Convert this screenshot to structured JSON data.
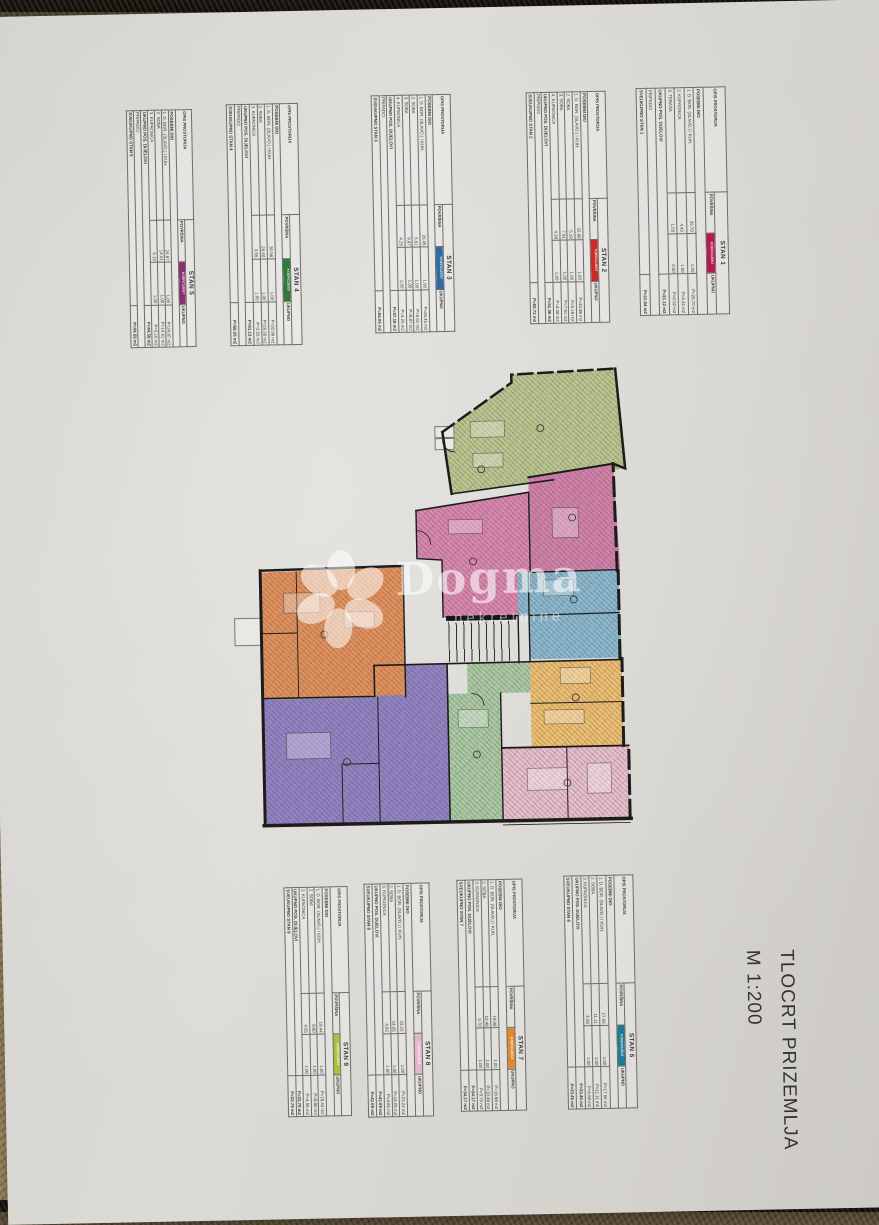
{
  "document": {
    "title_line1": "TLOCRT PRIZEMLJA",
    "title_line2": "M 1:200"
  },
  "watermark": {
    "brand": "Dogma",
    "subtitle": "nekretnine"
  },
  "table_template": {
    "col_opis": "OPIS PROSTORIJA",
    "col_povrsina": "POVRŠINA",
    "col_koeficijent": "KOEFICIJENT",
    "col_ukupno": "UKUPNO",
    "section_label": "POSEBNI DIO",
    "subtotal_label": "UKUPNO POS. DIJELOVI",
    "pripadci_label": "PRIPADCI"
  },
  "apartments": [
    {
      "name": "STAN 1",
      "color": "#b81a4f",
      "rows": [
        [
          "1. D. BOR. (SLAVO.) I KUH.",
          "26.70",
          "1.00",
          "P=26.70 m2"
        ],
        [
          "2. KUPAONICA",
          "4.42",
          "1.00",
          "P=4.42 m2"
        ],
        [
          "3. TERASA",
          "1.03",
          "0.50",
          "P=0.52 m2"
        ]
      ],
      "subtotal": "P=31.12 m2",
      "has_pripadci": true,
      "total_label": "SVEUKUPNO STAN 1",
      "total": "P=31.64 m2"
    },
    {
      "name": "STAN 2",
      "color": "#cc2a28",
      "rows": [
        [
          "1. D. BOR. (SLAVO.) I KUH.",
          "33.88",
          "1.00",
          "P=33.88 m2"
        ],
        [
          "2. SOBA",
          "5.19",
          "1.00",
          "P=5.19 m2"
        ],
        [
          "3. SOBA",
          "7.91",
          "1.00",
          "P=7.91 m2"
        ],
        [
          "4. KUPAONICA",
          "4.38",
          "1.00",
          "P=4.38 m2"
        ]
      ],
      "subtotal": "P=51.36 m2",
      "has_pripadci": true,
      "total_label": "SVEUKUPNO STAN 2",
      "total": "P=60.72 m2"
    },
    {
      "name": "STAN 3",
      "color": "#2e6da4",
      "rows": [
        [
          "1. D. BOR. (SLAVO.) I KUH.",
          "26.45",
          "1.00",
          "P=26.45 m2"
        ],
        [
          "2. SOBA",
          "6.61",
          "1.00",
          "P=6.61 m2"
        ],
        [
          "3. SOBA",
          "9.87",
          "1.00",
          "P=9.87 m2"
        ],
        [
          "4. KUPAONICA",
          "4.25",
          "1.00",
          "P=4.25 m2"
        ]
      ],
      "subtotal": "P=47.18 m2",
      "has_pripadci": true,
      "total_label": "SVEUKUPNO STAN 3",
      "total": "P=55.05 m2"
    },
    {
      "name": "STAN 4",
      "color": "#2f7a39",
      "rows": [
        [
          "1. D. BOR. (SLAVO.) I KUH.",
          "30.98",
          "1.00",
          "P=30.98 m2"
        ],
        [
          "2. SOBA",
          "26.60",
          "1.00",
          "P=26.60 m2"
        ],
        [
          "3. KUPAONICA",
          "3.55",
          "1.00",
          "P=3.55 m2"
        ]
      ],
      "subtotal": "P=61.13 m2",
      "has_pripadci": true,
      "total_label": "SVEUKUPNO STAN 4",
      "total": "P=68.26 m2"
    },
    {
      "name": "STAN 5",
      "color": "#8c2d6f",
      "rows": [
        [
          "1. D. BOR. (SLAVO.) I KUH.",
          "24.87",
          "1.00",
          "P=24.87 m2"
        ],
        [
          "2. SOBA",
          "14.61",
          "1.00",
          "P=14.61 m2"
        ],
        [
          "3. KUPAONICA",
          "5.10",
          "1.00",
          "P=5.10 m2"
        ]
      ],
      "subtotal": "P=44.58 m2",
      "has_pripadci": true,
      "total_label": "SVEUKUPNO STAN 5",
      "total": "P=44.58 m2"
    },
    {
      "name": "STAN 6",
      "color": "#1f7a96",
      "rows": [
        [
          "1. D. BOR. (SLAVO.) I KUH.",
          "17.66",
          "1.00",
          "P=17.66 m2"
        ],
        [
          "2. SOBA",
          "11.11",
          "1.00",
          "P=11.11 m2"
        ],
        [
          "3. KUPAONICA",
          "4.68",
          "1.00",
          "P=4.68 m2"
        ]
      ],
      "subtotal": "P=33.45 m2",
      "has_pripadci": false,
      "total_label": "SVEUKUPNO STAN 6",
      "total": "P=33.45 m2"
    },
    {
      "name": "STAN 7",
      "color": "#e08a2e",
      "rows": [
        [
          "1. D. BOR. (SLAVO.) I KUH.",
          "19.98",
          "1.00",
          "P=19.98 m2"
        ],
        [
          "2. SOBA",
          "10.49",
          "1.00",
          "P=10.49 m2"
        ],
        [
          "3. KUPAONICA",
          "3.70",
          "1.00",
          "P=3.70 m2"
        ]
      ],
      "subtotal": "P=34.17 m2",
      "has_pripadci": false,
      "total_label": "SVEUKUPNO STAN 7",
      "total": "P=34.17 m2"
    },
    {
      "name": "STAN 8",
      "color": "#e4b6c9",
      "rows": [
        [
          "1. D. BOR. (SLAVO.) I KUH.",
          "23.22",
          "1.00",
          "P=23.22 m2"
        ],
        [
          "2. SOBA",
          "14.05",
          "1.00",
          "P=14.05 m2"
        ],
        [
          "3. KUPAONICA",
          "4.82",
          "1.00",
          "P=4.82 m2"
        ]
      ],
      "subtotal": "P=42.09 m2",
      "has_pripadci": false,
      "total_label": "SVEUKUPNO STAN 8",
      "total": "P=42.09 m2"
    },
    {
      "name": "STAN 9",
      "color": "#a8c23f",
      "rows": [
        [
          "1. D. BOR. (SLAVO.) I KUH.",
          "19.44",
          "1.00",
          "P=19.44 m2"
        ],
        [
          "2. SOBA",
          "9.80",
          "1.00",
          "P=9.80 m2"
        ],
        [
          "3. KUPAONICA",
          "4.55",
          "1.00",
          "P=4.55 m2"
        ]
      ],
      "subtotal": "P=33.79 m2",
      "has_pripadci": false,
      "total_label": "SVEUKUPNO STAN 9",
      "total": "P=33.79 m2"
    }
  ],
  "plan": {
    "regions": [
      {
        "key": "green-top",
        "color": "#b9c58f"
      },
      {
        "key": "pink-center",
        "color": "#d788ae"
      },
      {
        "key": "pink-right",
        "color": "#d083a9"
      },
      {
        "key": "blue-right",
        "color": "#8ab8cd"
      },
      {
        "key": "amber-right",
        "color": "#eabf72"
      },
      {
        "key": "lightpink-bottom",
        "color": "#e6bfce"
      },
      {
        "key": "green-center",
        "color": "#a9c9a3"
      },
      {
        "key": "purple",
        "color": "#9184c2"
      },
      {
        "key": "orange-left",
        "color": "#df925d"
      }
    ]
  }
}
